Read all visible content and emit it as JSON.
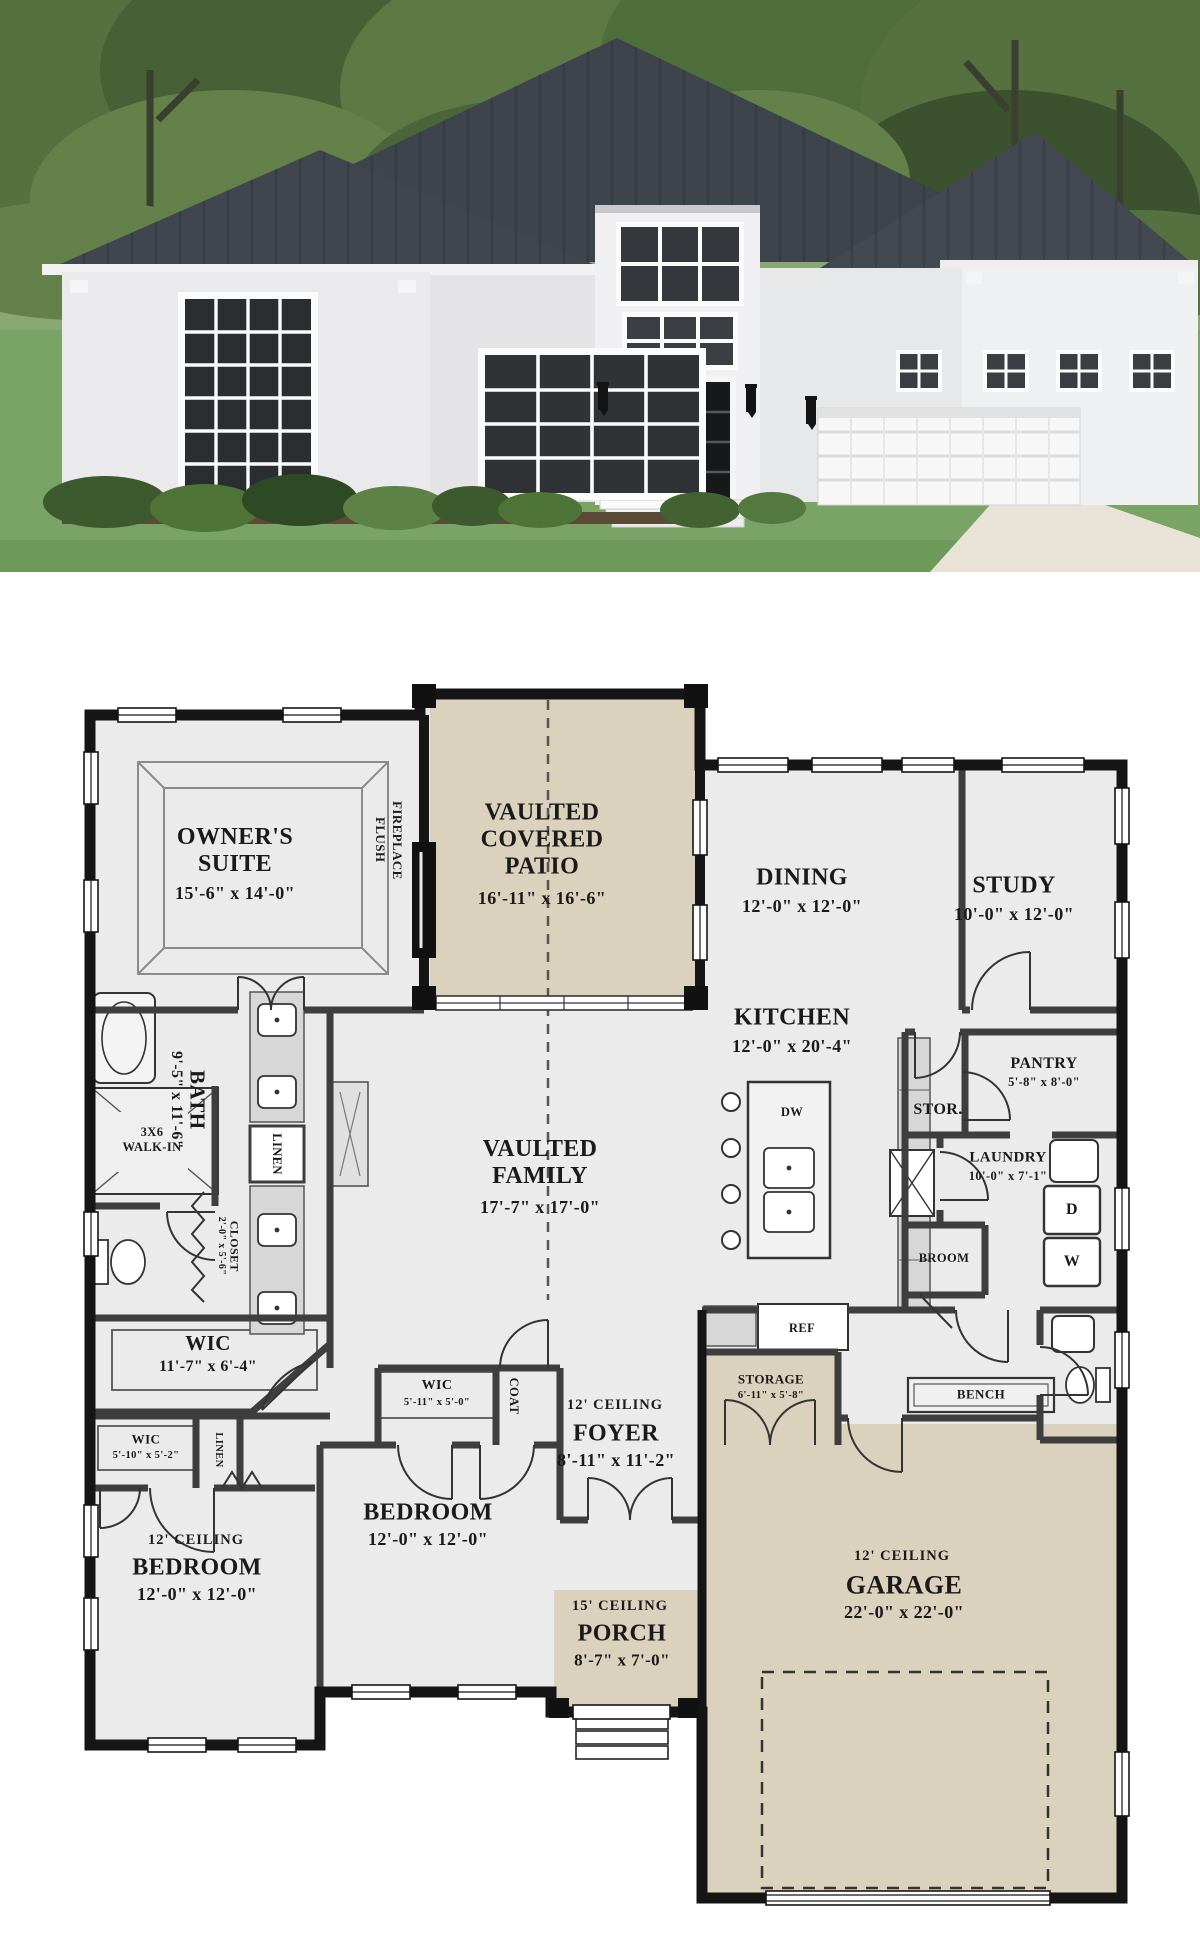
{
  "hero": {
    "description_icon": "house-rendering",
    "colors": {
      "roof": "#3e444b",
      "house_walls": "#ebebed",
      "front_door": "#1b1c1e",
      "garage_door": "#f7f7f7",
      "lawn": "#74a05e",
      "foliage": "#4e6f3c",
      "driveway": "#e8e3d6",
      "sky": "#cfd8c4"
    }
  },
  "plan": {
    "colors": {
      "background": "#ffffff",
      "floor": "#ebebeb",
      "outdoor_floor": "#dbd2bd",
      "exterior_wall": "#151515",
      "interior_wall": "#3e3e3e",
      "text": "#1a1a1a"
    },
    "owners_suite": {
      "name": "OWNER'S SUITE",
      "dims": "15'-6\" x 14'-0\""
    },
    "patio": {
      "name": "VAULTED COVERED PATIO",
      "dims": "16'-11\" x 16'-6\""
    },
    "fireplace": {
      "name": "FLUSH FIREPLACE"
    },
    "dining": {
      "name": "DINING",
      "dims": "12'-0\" x 12'-0\""
    },
    "study": {
      "name": "STUDY",
      "dims": "10'-0\" x 12'-0\""
    },
    "kitchen": {
      "name": "KITCHEN",
      "dims": "12'-0\" x 20'-4\"",
      "dw": "DW",
      "ref": "REF"
    },
    "family": {
      "name": "VAULTED FAMILY",
      "dims": "17'-7\" x 17'-0\""
    },
    "bath": {
      "name": "BATH",
      "dims": "9'-5\" x 11'-6\""
    },
    "walk_in_shower": {
      "name": "3X6 WALK-IN"
    },
    "linen_bath": {
      "name": "LINEN"
    },
    "closet_bath": {
      "name": "CLOSET",
      "dims": "2'-0\" x 5'-6\""
    },
    "wic_owner": {
      "name": "WIC",
      "dims": "11'-7\" x 6'-4\""
    },
    "pantry": {
      "name": "PANTRY",
      "dims": "5'-8\" x 8'-0\""
    },
    "stor": {
      "name": "STOR."
    },
    "laundry": {
      "name": "LAUNDRY",
      "dims": "10'-0\" x 7'-1\"",
      "dryer": "D",
      "washer": "W"
    },
    "broom": {
      "name": "BROOM"
    },
    "storage": {
      "name": "STORAGE",
      "dims": "6'-11\" x 5'-8\""
    },
    "bench": {
      "name": "BENCH"
    },
    "foyer": {
      "ceiling": "12' CEILING",
      "name": "FOYER",
      "dims": "8'-11\" x 11'-2\""
    },
    "wic_center": {
      "name": "WIC",
      "dims": "5'-11\" x 5'-0\""
    },
    "coat": {
      "name": "COAT"
    },
    "wic_left": {
      "name": "WIC",
      "dims": "5'-10\" x 5'-2\""
    },
    "linen_hall": {
      "name": "LINEN"
    },
    "bedroom_left": {
      "ceiling": "12' CEILING",
      "name": "BEDROOM",
      "dims": "12'-0\" x 12'-0\""
    },
    "bedroom_center": {
      "name": "BEDROOM",
      "dims": "12'-0\" x 12'-0\""
    },
    "porch": {
      "ceiling": "15' CEILING",
      "name": "PORCH",
      "dims": "8'-7\" x 7'-0\""
    },
    "garage": {
      "ceiling": "12' CEILING",
      "name": "GARAGE",
      "dims": "22'-0\" x 22'-0\""
    }
  }
}
